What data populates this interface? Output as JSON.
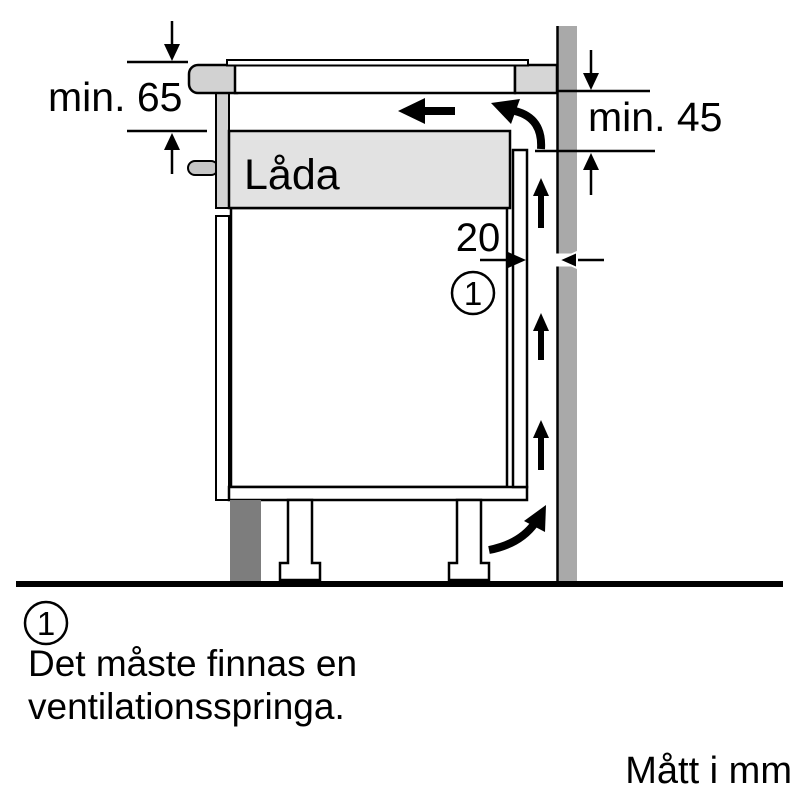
{
  "diagram": {
    "title_context": "hob-installation-side-view",
    "labels": {
      "min_clearance_under_worktop": "min. 65",
      "min_clearance_back_partition": "min. 45",
      "vent_gap_mm": "20",
      "drawer": "Låda",
      "callout_marker": "1"
    },
    "footnote": {
      "marker": "1",
      "line1": "Det måste finnas en",
      "line2": "ventilationsspringa."
    },
    "units_note": "Mått i mm",
    "colors": {
      "wall": "#a9a9a9",
      "worktop_edge": "#d2d2d2",
      "worktop_back": "#d6d6d6",
      "drawer_fill": "#e2e2e2",
      "drawer_front": "#d2d2d2",
      "handle": "#c6c6c6",
      "plinth": "#7d7d7d",
      "glass": "#ffffff",
      "cabinet": "#ffffff",
      "outline": "#000000"
    }
  }
}
